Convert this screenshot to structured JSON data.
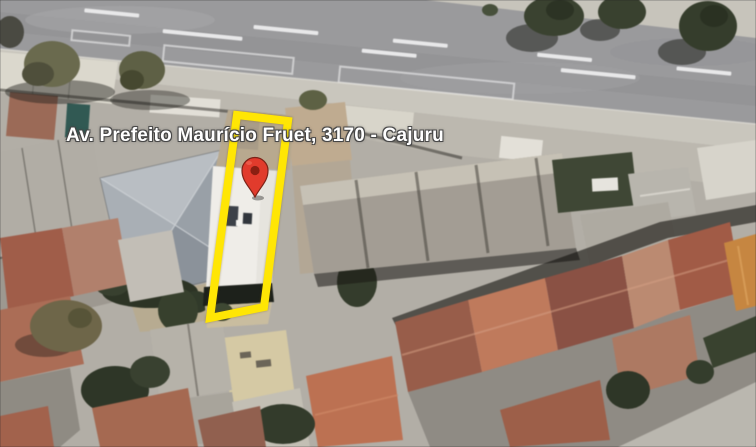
{
  "map_view": {
    "address_label": "Av. Prefeito Maurício Fruet, 3170 - Cajuru",
    "highlight": {
      "name": "property-outline",
      "color": "#FFE604"
    },
    "pin": {
      "name": "location-pin",
      "color": "#E13B2C",
      "dot_color": "#8A1F12",
      "outline_color": "#7C2318"
    }
  }
}
